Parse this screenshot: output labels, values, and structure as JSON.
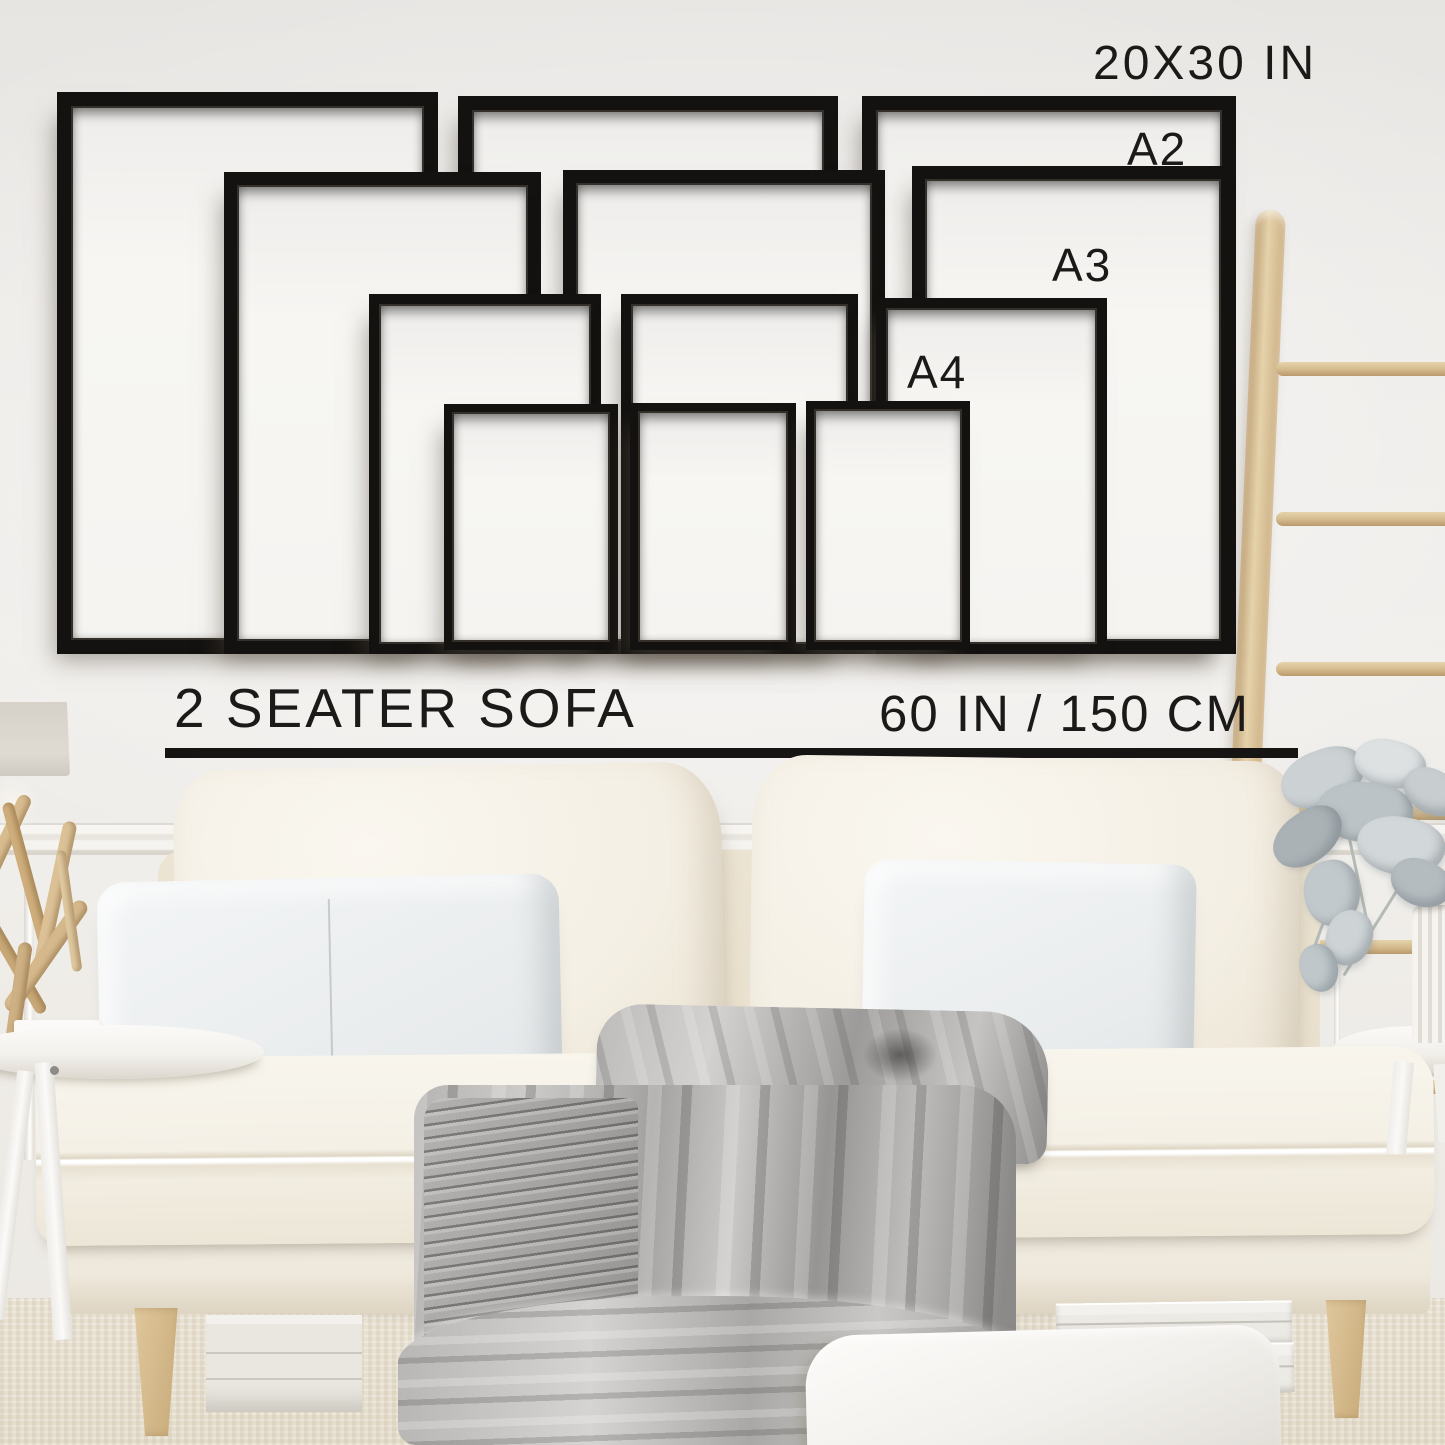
{
  "size_guide": {
    "frame_sizes": [
      {
        "id": "20x30",
        "label": "20X30 IN",
        "frames_shown": 3
      },
      {
        "id": "a2",
        "label": "A2",
        "frames_shown": 3
      },
      {
        "id": "a3",
        "label": "A3",
        "frames_shown": 3
      },
      {
        "id": "a4",
        "label": "A4",
        "frames_shown": 3
      }
    ],
    "reference_item": {
      "label": "2 SEATER SOFA",
      "width": "60 IN / 150 CM"
    }
  },
  "colors": {
    "frame": "#141210",
    "label_text": "#1b1a18",
    "wall": "#edebe8",
    "ladder_wood": "#d8c29c",
    "sofa_fabric": "#f2ede2",
    "blanket": "#a9a8a6",
    "floor": "#e8e1d2"
  },
  "scene_objects": [
    "empty-picture-frames",
    "wooden-blanket-ladder",
    "eucalyptus-plant",
    "two-seater-sofa",
    "throw-pillows",
    "cable-knit-blanket",
    "round-side-tables",
    "driftwood-decor",
    "floor-cushion",
    "storage-boxes"
  ]
}
